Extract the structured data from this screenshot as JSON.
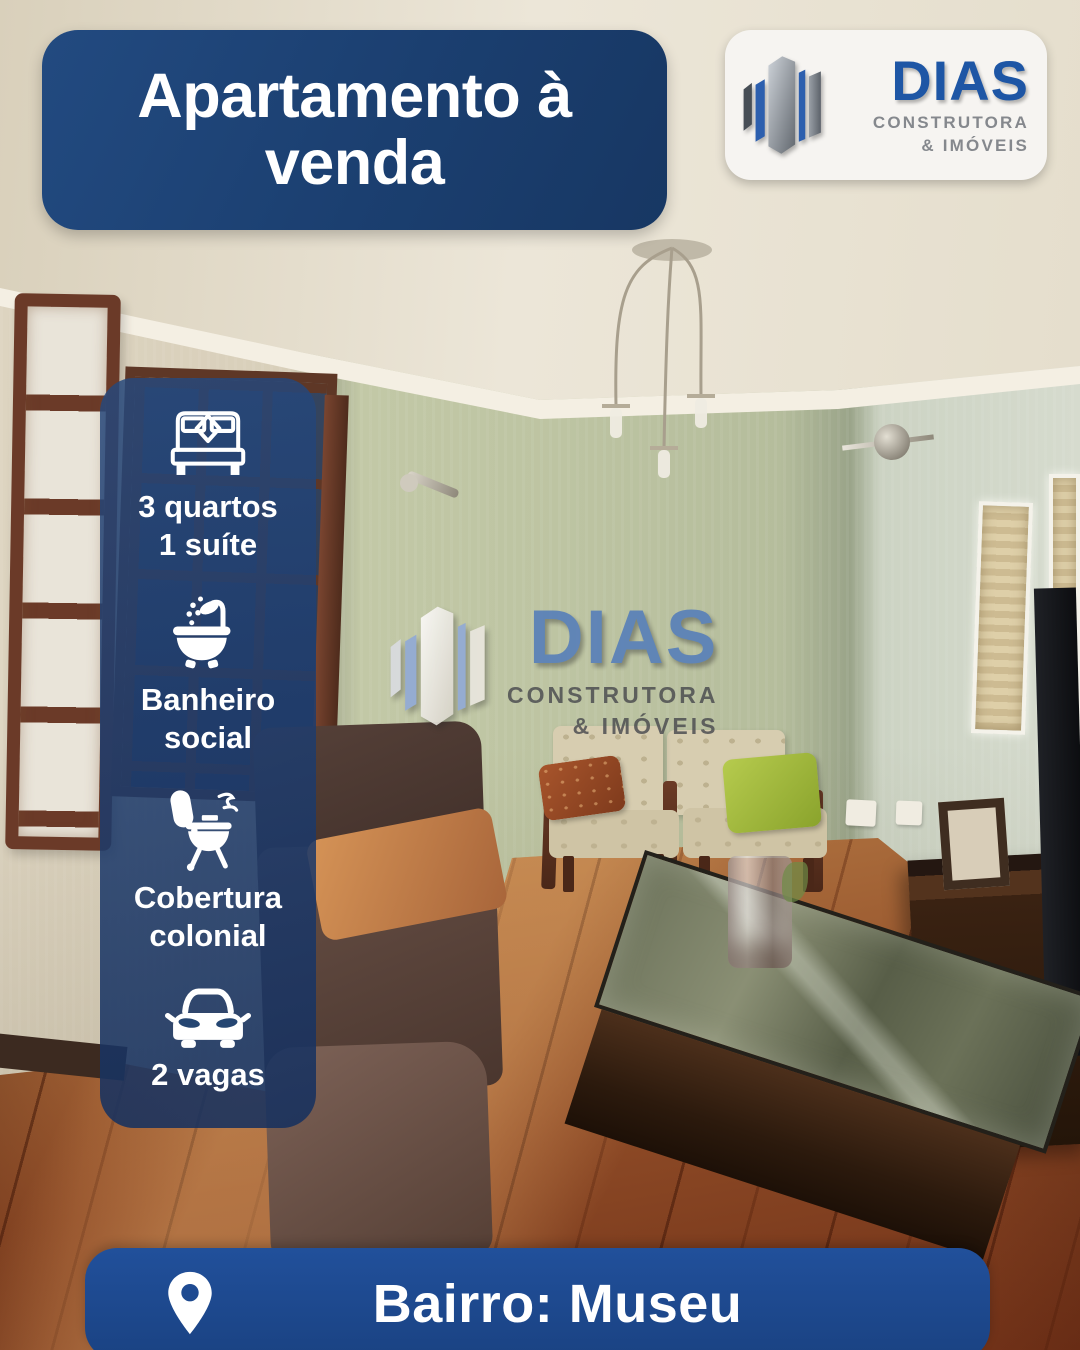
{
  "title": "Apartamento à\nvenda",
  "brand": {
    "icon": "building-icon",
    "name": "DIAS",
    "tagline1": "CONSTRUTORA",
    "tagline2": "& IMÓVEIS"
  },
  "watermark": {
    "icon": "building-icon",
    "name": "DIAS",
    "tagline1": "CONSTRUTORA",
    "tagline2": "& IMÓVEIS"
  },
  "features": [
    {
      "icon": "bed-icon",
      "text": "3 quartos\n1 suíte"
    },
    {
      "icon": "bathtub-icon",
      "text": "Banheiro\nsocial"
    },
    {
      "icon": "barbecue-grill-icon",
      "text": "Cobertura\ncolonial"
    },
    {
      "icon": "car-icon",
      "text": "2 vagas"
    }
  ],
  "location": {
    "icon": "location-pin-icon",
    "label": "Bairro: Museu"
  },
  "colors": {
    "title_box_blue": "#1c4173",
    "panel_blue": "rgba(30,62,112,0.85)",
    "location_bar_blue": "#1d4a8c",
    "logo_blue": "#1e5aa8",
    "logo_gray": "#85888d",
    "text_white": "#ffffff"
  }
}
